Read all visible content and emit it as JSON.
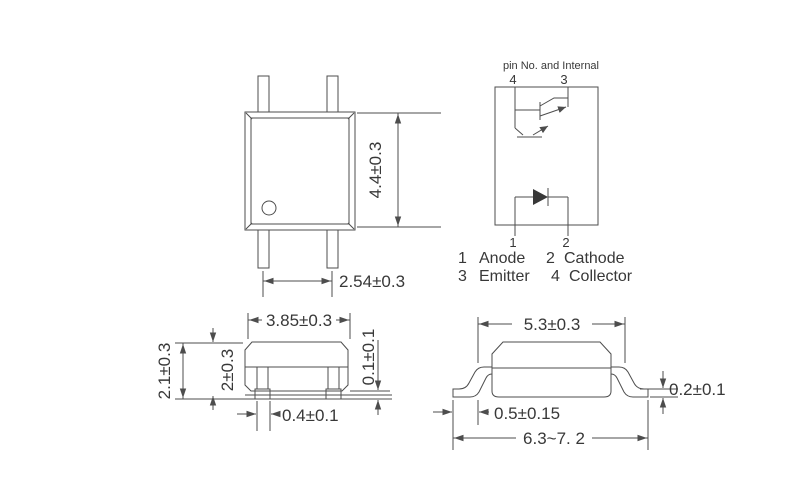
{
  "canvas": {
    "background": "#ffffff",
    "line_color": "#4d4d4d",
    "text_color": "#383838"
  },
  "internal_diagram": {
    "title": "pin No. and Internal",
    "top_pins": {
      "left": "4",
      "right": "3"
    },
    "bottom_pins": {
      "left": "1",
      "right": "2"
    },
    "legend": [
      {
        "pin": "1",
        "function": "Anode"
      },
      {
        "pin": "2",
        "function": "Cathode"
      },
      {
        "pin": "3",
        "function": "Emitter"
      },
      {
        "pin": "4",
        "function": "Collector"
      }
    ]
  },
  "dimensions": {
    "top_view": {
      "body_height": "4.4±0.3",
      "pin_pitch": "2.54±0.3"
    },
    "side_view": {
      "body_width": "3.85±0.3",
      "total_height": "2.1±0.3",
      "body_height": "2±0.3",
      "standoff": "0.1±0.1",
      "lead_width": "0.4±0.1"
    },
    "front_view": {
      "body_width": "5.3±0.3",
      "foot_length": "0.5±0.15",
      "lead_thickness": "0.2±0.1",
      "overall_span": "6.3~7. 2"
    }
  }
}
